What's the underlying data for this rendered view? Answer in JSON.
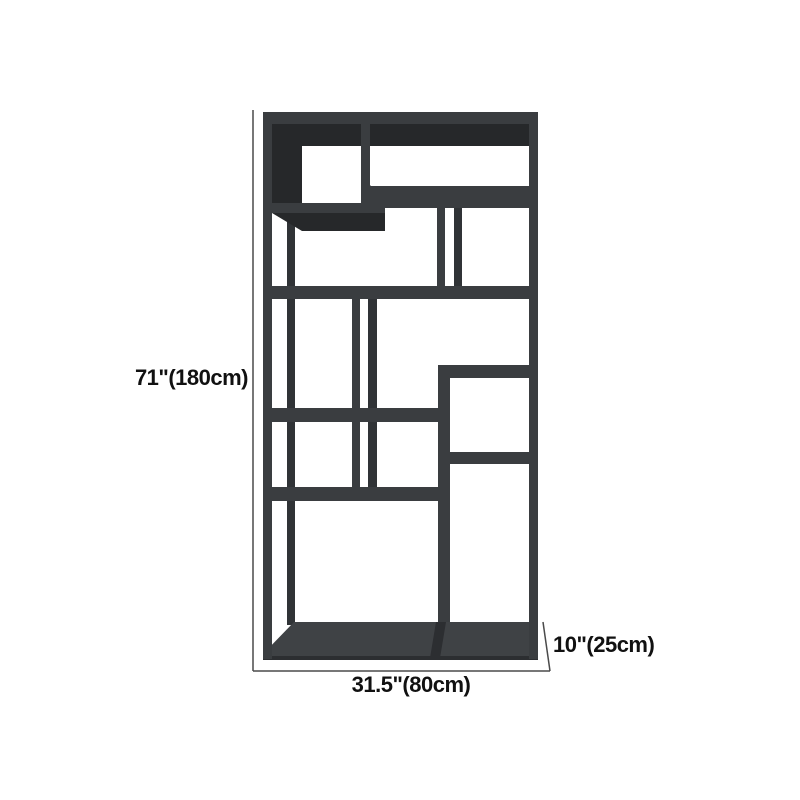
{
  "product": {
    "name": "geometric-display-bookshelf",
    "view": "front dimension diagram"
  },
  "dimensions": {
    "height": "71\"(180cm)",
    "width": "31.5\"(80cm)",
    "depth": "10\"(25cm)"
  },
  "colors": {
    "frame": "#3a3d40",
    "frame_back": "#303336",
    "inner_shadow": "#26282a",
    "base_top": "#3f4245",
    "seam": "#2c2e31",
    "dimension_line": "#4a4a4a",
    "label_text": "#111111",
    "background": "#ffffff"
  }
}
